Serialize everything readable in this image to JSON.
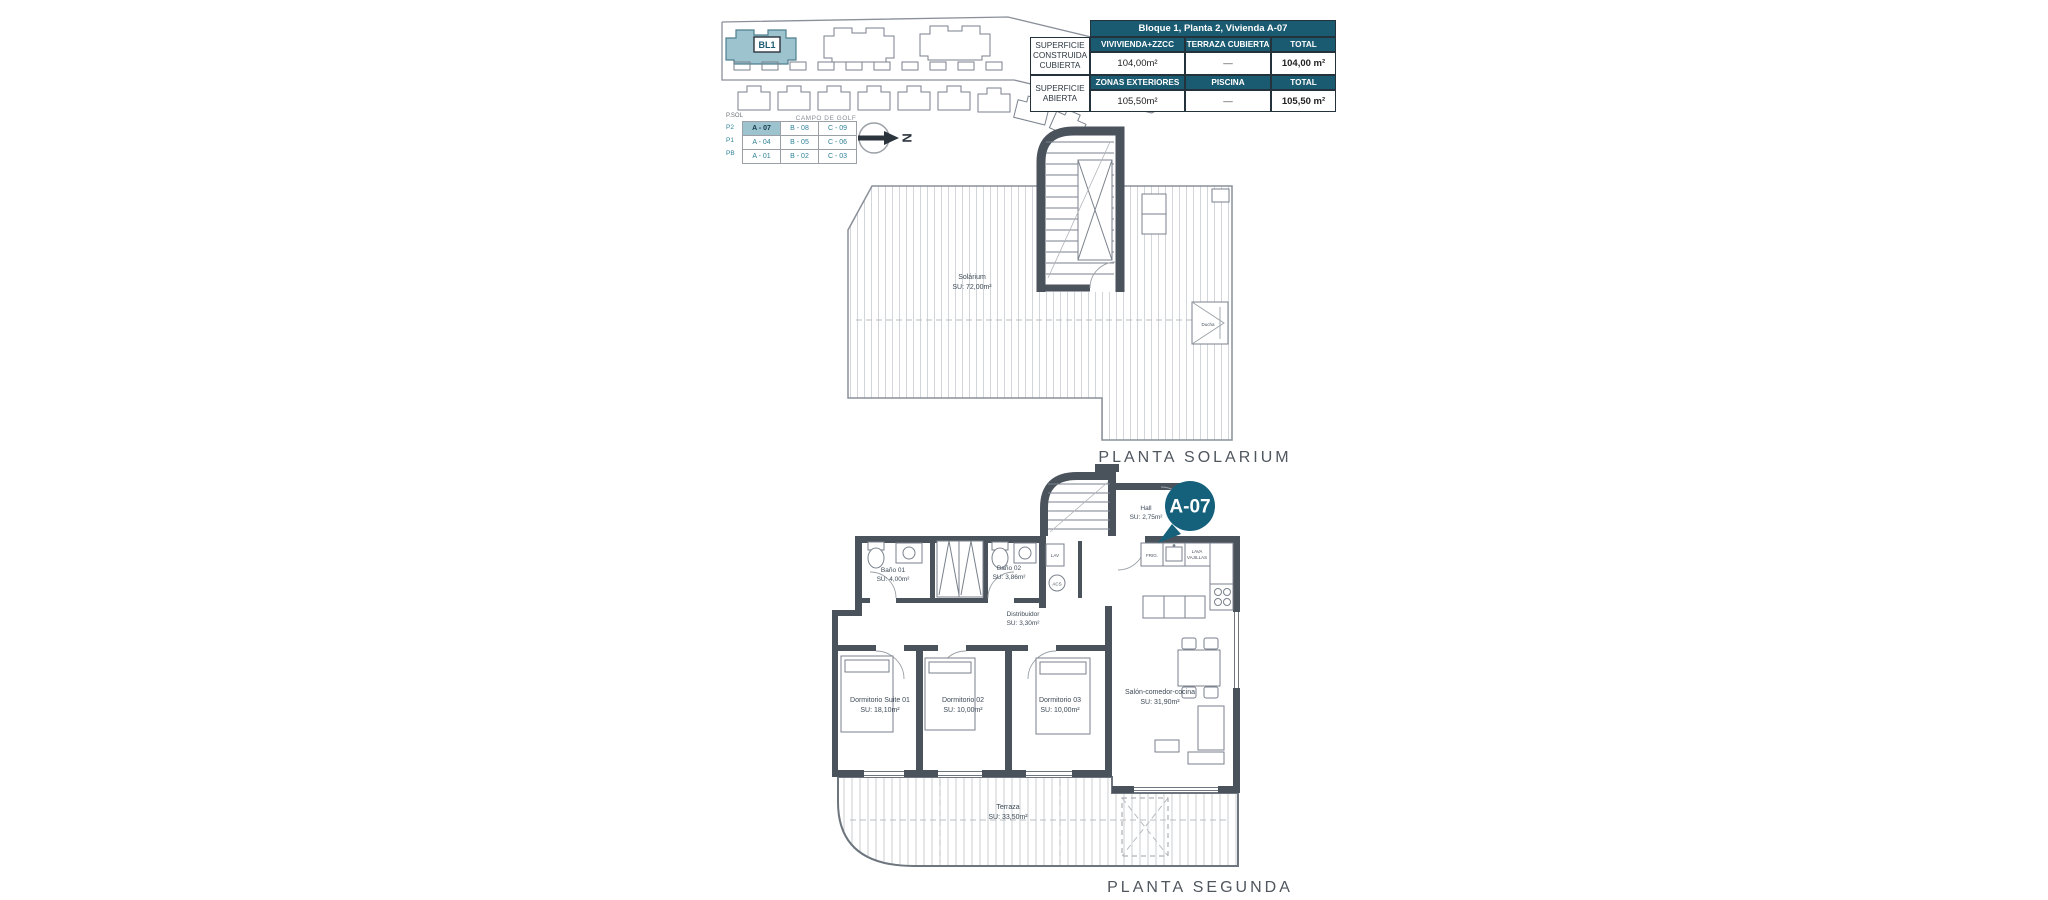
{
  "site_plan": {
    "block_label": "BL1",
    "road_label": "CAMPO DE GOLF"
  },
  "legend": {
    "caption": "P.SOL",
    "rows": [
      {
        "level": "P2",
        "cells": [
          "A - 07",
          "B - 08",
          "C - 09"
        ]
      },
      {
        "level": "P1",
        "cells": [
          "A - 04",
          "B - 05",
          "C - 06"
        ]
      },
      {
        "level": "PB",
        "cells": [
          "A - 01",
          "B - 02",
          "C - 03"
        ]
      }
    ]
  },
  "north": {
    "letter": "N"
  },
  "area_table": {
    "title": "Bloque 1, Planta 2, Vivienda A-07",
    "row_groups": [
      {
        "label": "SUPERFICIE CONSTRUIDA CUBIERTA",
        "headers": [
          "VIVIVIENDA+ZZCC",
          "TERRAZA CUBIERTA",
          "TOTAL"
        ],
        "values": [
          "104,00m²",
          "—",
          "104,00 m²"
        ]
      },
      {
        "label": "SUPERFICIE ABIERTA",
        "headers": [
          "ZONAS EXTERIORES",
          "PISCINA",
          "TOTAL"
        ],
        "values": [
          "105,50m²",
          "—",
          "105,50 m²"
        ]
      }
    ]
  },
  "solarium_plan": {
    "caption": "PLANTA SOLARIUM",
    "room": {
      "name": "Solárium",
      "area": "SU: 72,00m²"
    },
    "shower": {
      "name": "Ducha"
    }
  },
  "segunda_plan": {
    "caption": "PLANTA SEGUNDA",
    "badge": "A-07",
    "rooms": {
      "hall": {
        "name": "Hall",
        "area": "SU: 2,75m²"
      },
      "bano1": {
        "name": "Baño 01",
        "area": "SU: 4,00m²"
      },
      "bano2": {
        "name": "Baño 02",
        "area": "SU: 3,86m²"
      },
      "distribuidor": {
        "name": "Distribuidor",
        "area": "SU: 3,30m²"
      },
      "suite": {
        "name": "Dormitorio Suite 01",
        "area": "SU: 18,10m²"
      },
      "dorm2": {
        "name": "Dormitorio 02",
        "area": "SU: 10,00m²"
      },
      "dorm3": {
        "name": "Dormitorio 03",
        "area": "SU: 10,00m²"
      },
      "salon": {
        "name": "Salón-comedor-cocina",
        "area": "SU: 31,90m²"
      },
      "terraza": {
        "name": "Terraza",
        "area": "SU: 33,50m²"
      }
    },
    "kitchen": {
      "fridge": "FRIG.",
      "dishwasher_line1": "LAVA",
      "dishwasher_line2": "VAJILLAS",
      "laundry": "LAV",
      "heater": "ACS"
    }
  },
  "colors": {
    "teal_dark": "#1b5b72",
    "teal_badge": "#15607b",
    "teal_light": "#9dc3cf",
    "teal_text": "#2e8298",
    "wall": "#4a525c"
  }
}
